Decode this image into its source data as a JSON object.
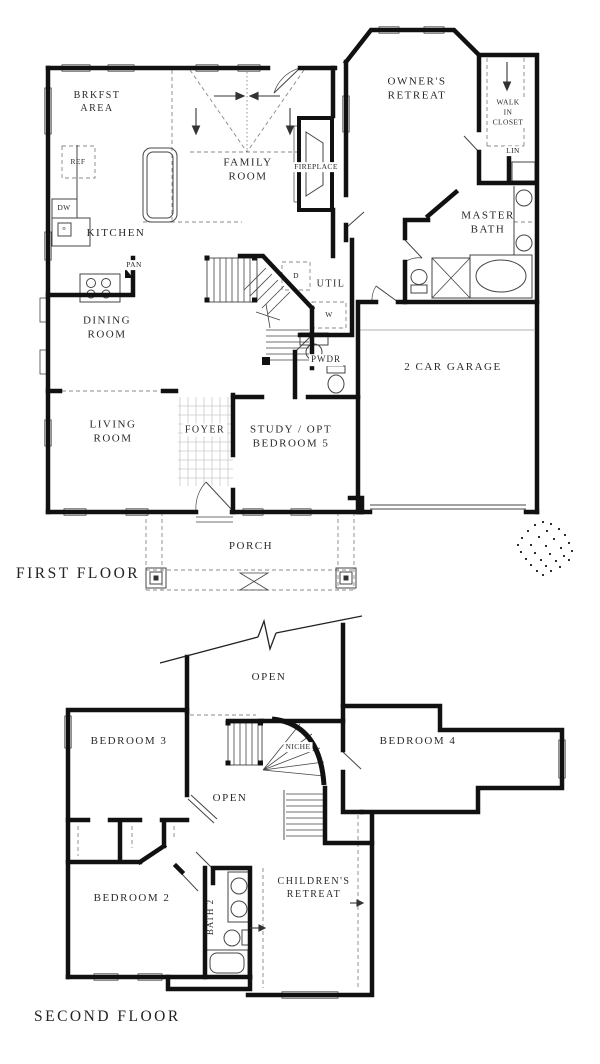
{
  "plan": {
    "first_floor": {
      "title": "FIRST FLOOR",
      "rooms": {
        "brkfst_area": "BRKFST\nAREA",
        "family_room": "FAMILY\nROOM",
        "fireplace": "FIREPLACE",
        "owners_retreat": "OWNER'S\nRETREAT",
        "walk_in_closet": "WALK\nIN\nCLOSET",
        "linen": "LIN",
        "refrigerator": "REF",
        "dishwasher": "DW",
        "oven": "o",
        "kitchen": "KITCHEN",
        "pantry": "PAN",
        "dining_room": "DINING\nROOM",
        "utility": "UTIL",
        "dryer": "D",
        "washer": "W",
        "powder": "PWDR",
        "master_bath": "MASTER\nBATH",
        "garage": "2 CAR GARAGE",
        "living_room": "LIVING\nROOM",
        "foyer": "FOYER",
        "study": "STUDY / OPT\nBEDROOM 5",
        "porch": "PORCH"
      }
    },
    "second_floor": {
      "title": "SECOND FLOOR",
      "rooms": {
        "open_upper": "OPEN",
        "bedroom_3": "BEDROOM 3",
        "niche": "NICHE",
        "bedroom_4": "BEDROOM 4",
        "open_lower": "OPEN",
        "bedroom_2": "BEDROOM 2",
        "bath_2": "BATH 2",
        "childrens_retreat": "CHILDREN'S\nRETREAT"
      }
    },
    "colors": {
      "wall": "#111111",
      "line": "#444444",
      "text": "#2a2a2a",
      "background": "#ffffff"
    }
  }
}
